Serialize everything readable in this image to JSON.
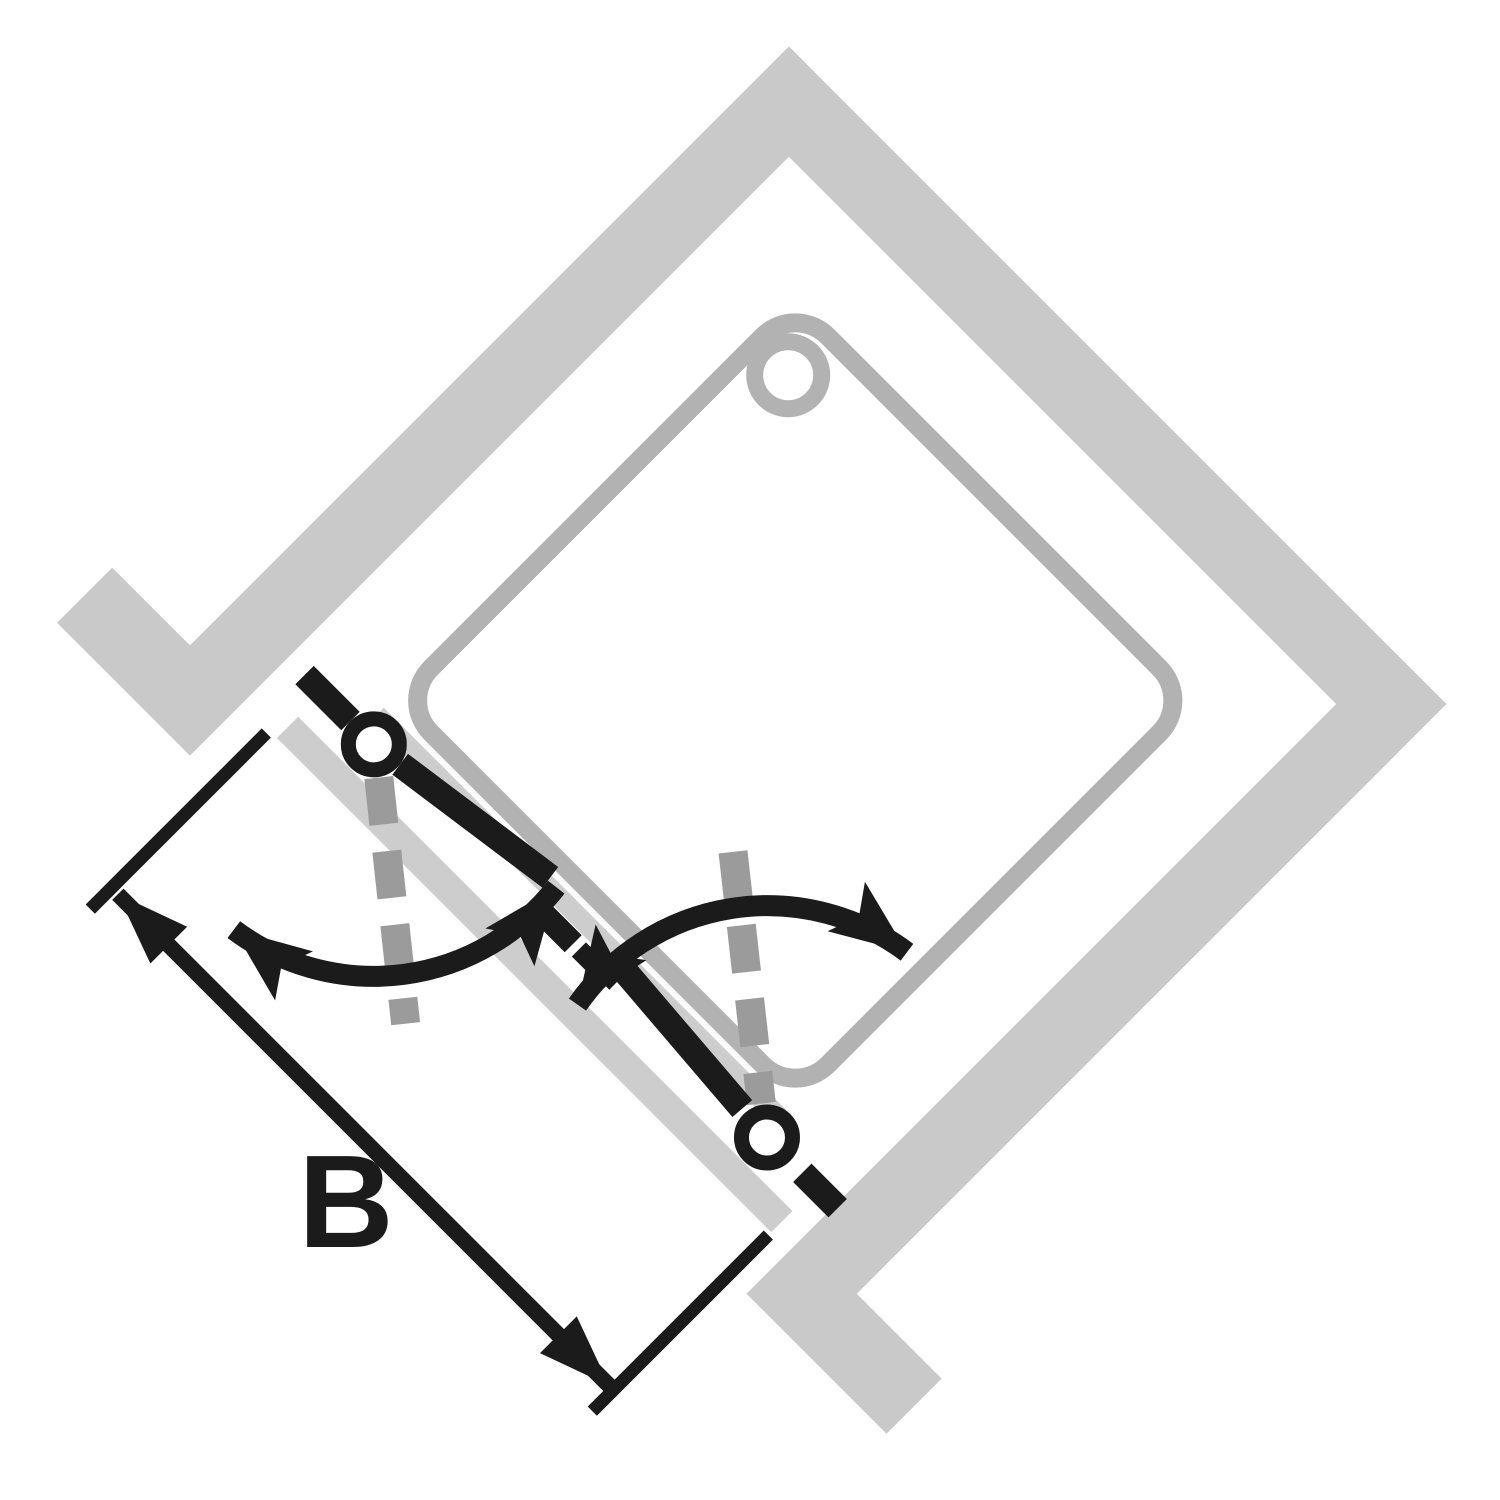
{
  "figure": {
    "type": "plan-view pictogram",
    "subject": "corner shower enclosure with two pivot swing doors on the diagonal entry side, drawn rotated 45 degrees",
    "dimension_label": "B",
    "colors": {
      "background": "#ffffff",
      "wall": "#c9c9c9",
      "panel": "#cdcdcd",
      "tray": "#b2b2b2",
      "axis": "#9b9b9b",
      "ink": "#1b1b1b",
      "white": "#ffffff"
    },
    "elements": [
      "room-walls",
      "wall-end-stubs",
      "shower-tray",
      "drain",
      "entry-side-panels",
      "left-pivot-door",
      "right-pivot-door",
      "pivot-hinges",
      "pivot-axis-dashed-lines",
      "door-swing-arrows",
      "closed-position-dashes",
      "width-dimension-arrow",
      "dimension-extension-lines"
    ]
  }
}
